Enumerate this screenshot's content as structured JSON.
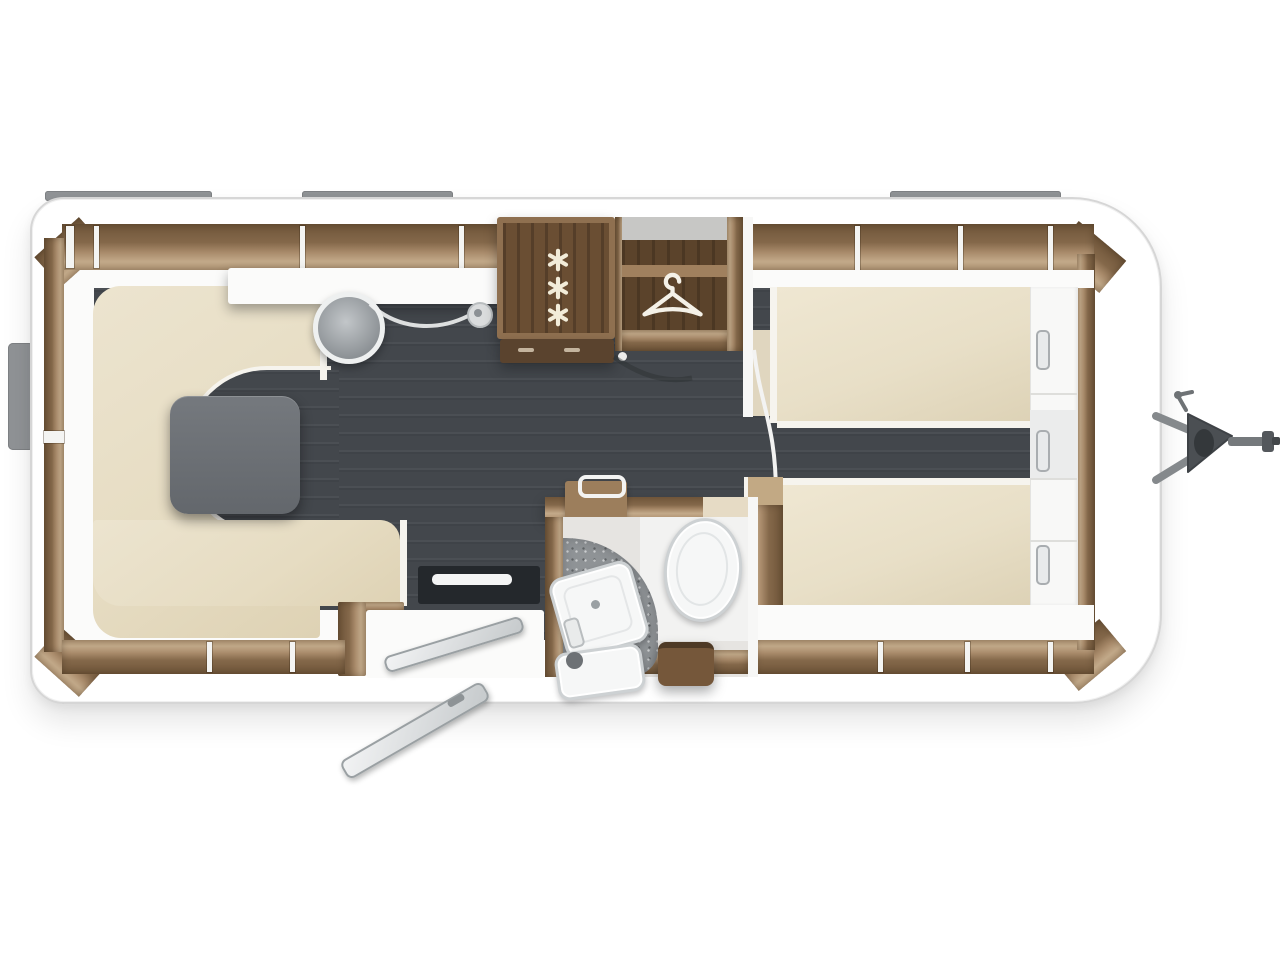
{
  "meta": {
    "kind": "caravan-floor-plan",
    "view": "top-down",
    "canvas_w": 1280,
    "canvas_h": 960
  },
  "palette": {
    "background": "#ffffff",
    "body_fill": "#ffffff",
    "body_border": "#d6d6d6",
    "floor_dark": "#43474c",
    "wood_dark": "#6f5539",
    "wood_mid": "#a98b6b",
    "wood_light": "#c3aa8a",
    "upholstery_cream": "#e9e0c8",
    "bed_cream": "#ece3cd",
    "table_gray": "#6e7277",
    "window_gray": "#909396",
    "shower_gray": "#8f9396",
    "fixture_white": "#f6f7f7",
    "hitch_bar": "#85898c",
    "hitch_body": "#4b4f53"
  },
  "areas": {
    "lounge": {
      "name": "u-shaped-front-lounge",
      "seat_sections": 3,
      "table": true
    },
    "kitchen": {
      "name": "kitchen",
      "burner_count": 3,
      "sink": true,
      "faucet": true
    },
    "wardrobe": {
      "name": "wardrobe",
      "icon": "clothes-hanger-icon"
    },
    "bathroom": {
      "name": "bathroom",
      "fixtures": [
        "toilet",
        "washbasin",
        "shower-floor",
        "second-basin",
        "stool"
      ]
    },
    "bedroom": {
      "name": "twin-single-beds",
      "beds": 2,
      "cabinet_handles": 3
    },
    "entrance": {
      "name": "entry-door-open",
      "step": true,
      "threshold": true
    },
    "hitch": {
      "name": "tow-hitch",
      "side": "right"
    }
  },
  "exterior": {
    "windows_top": 3,
    "windows_bottom": 2,
    "windows_rear": 1,
    "tow_hitch": true
  },
  "icons": [
    "clothes-hanger-icon",
    "gas-burner-icon",
    "kitchen-sink-icon",
    "faucet-icon",
    "toilet-icon",
    "washbasin-icon",
    "shower-floor-icon",
    "entry-door-icon",
    "entry-step-icon",
    "tow-hitch-icon",
    "window-icon"
  ]
}
